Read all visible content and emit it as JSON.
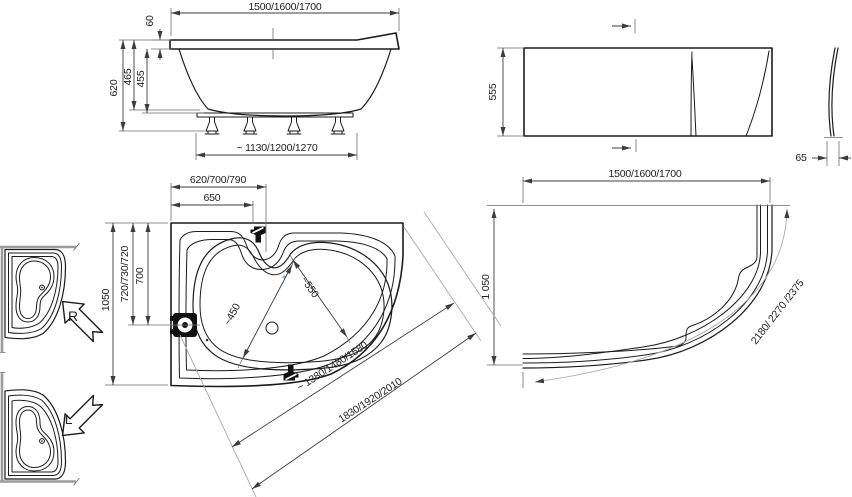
{
  "front_view": {
    "width": "1500/1600/1700",
    "rim_height": "60",
    "total_height": "620",
    "shell_height": "465",
    "inner_height": "455",
    "foot_span": "~ 1130/1200/1270"
  },
  "apron_front": {
    "height": "555",
    "profile_thickness": "65"
  },
  "apron_top": {
    "width": "1500/1600/1700",
    "depth": "1 050",
    "arc_length": "2180/ 2270 /2375"
  },
  "tub_top": {
    "corner_width": "620/700/790",
    "faucet_offset": "650",
    "depth": "1050",
    "drain_depth": "720/730/720",
    "drain_depth_inner": "700",
    "basin_width_narrow": "~450",
    "basin_width_wide": "~550",
    "diagonal_inner": "~ 1380/1480/1580",
    "diagonal_overall": "1830/1920/2010"
  },
  "variants": {
    "right": "R",
    "left": "L"
  },
  "colors": {
    "line": "#1b1b1b",
    "dim": "#3c3c3c",
    "light": "#aaaaaa",
    "accent_dot": "#79b6d9"
  }
}
